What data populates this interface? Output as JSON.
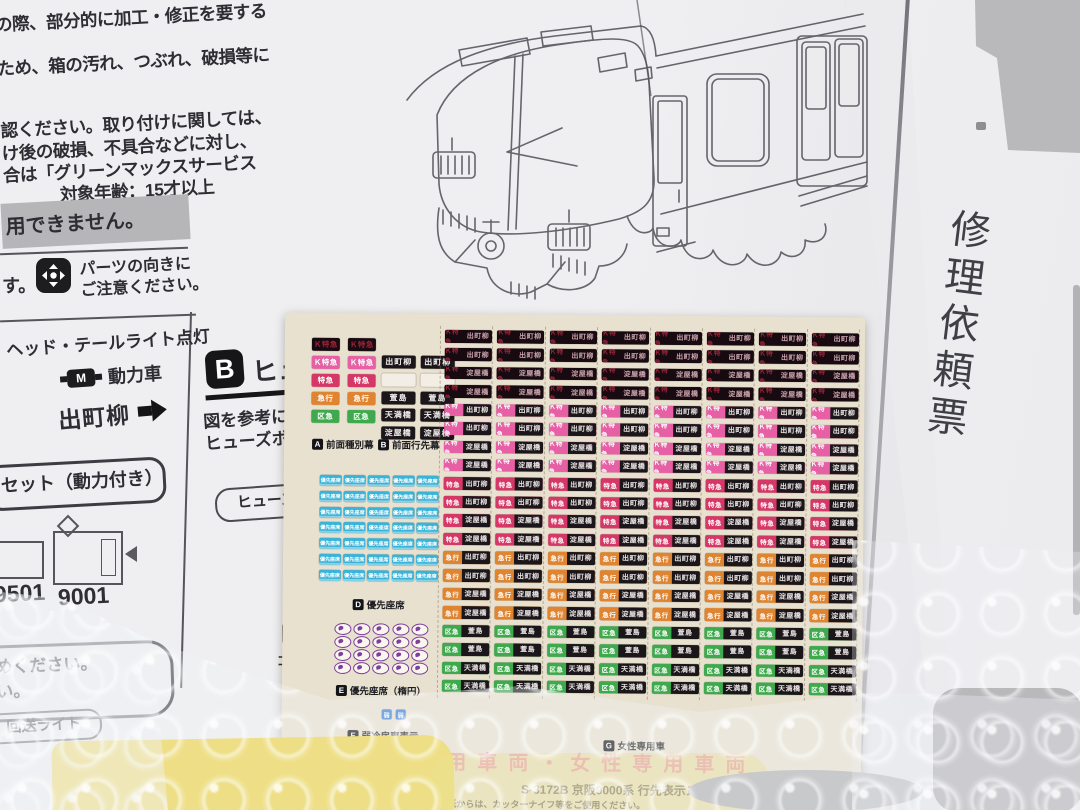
{
  "colors": {
    "led_bg": "#170b11",
    "led_text": "#9d2439",
    "dest_bg": "#1b161a",
    "dest_text": "#e9e3e3",
    "k_limited_express_pink": "#e75fa4",
    "limited_express_crimson": "#d53866",
    "express_orange": "#df8430",
    "sub_express_green": "#3fa94d",
    "priority_seat_blue": "#39b3d8",
    "priority_seat_purple": "#7d3f9b",
    "banner_pink": "#ea77ad",
    "gray_band": "#b6b6b8",
    "sheet_beige": "#e9e1d0",
    "yellow_item": "#eed54a"
  },
  "left_column": {
    "line1": "の際、部分的に加工・修正を要する",
    "line2": "ため、箱の汚れ、つぶれ、破損等に",
    "line3": "認ください。取り付けに関しては、",
    "line4": "け後の破損、不具合などに対し、",
    "line5": "合は「グリーンマックスサービス",
    "age_note": "対象年齢：15才以上",
    "gray_band": "用できません。",
    "fragment_su": "す。",
    "parts_note_line1": "パーツの向きに",
    "parts_note_line2": "ご注意ください。",
    "light_note": "ヘッド・テールライト点灯",
    "motor_icon_letter": "M",
    "motor_label": "動力車",
    "destination_label": "出町柳",
    "set_label": "セット（動力付き）",
    "num_left": "9501",
    "num_right": "9001",
    "round_note_line1": "かめください。",
    "round_note_line2": "さい。",
    "kaisou_label": "回送ライト",
    "gomu_fragment": "ゴム"
  },
  "section_b_panel": {
    "badge": "B",
    "heading_fragment": "ヒュ",
    "body_line1": "図を参考に",
    "body_line2": "ヒューズボ",
    "stadium_fragment": "ヒューズポ"
  },
  "repair_slip": {
    "vertical_title": "修理依頼票"
  },
  "sheet": {
    "section_a": {
      "badge": "A",
      "label": "前面種別幕",
      "stickers": [
        {
          "text": "Ｋ特急",
          "style": "led"
        },
        {
          "text": "Ｋ特急",
          "style": "kltd"
        },
        {
          "text": "特急",
          "style": "ltd"
        },
        {
          "text": "急行",
          "style": "exp"
        },
        {
          "text": "区急",
          "style": "sub"
        }
      ]
    },
    "section_b": {
      "badge": "B",
      "label": "前面行先幕",
      "stickers": [
        "出町柳",
        "",
        "萱島",
        "天満橋",
        "淀屋橋"
      ]
    },
    "side_grid": {
      "columns": 8,
      "rows_per_combo": 2,
      "combos": [
        {
          "type": "Ｋ特急",
          "dest": "出町柳",
          "style": "led"
        },
        {
          "type": "Ｋ特急",
          "dest": "淀屋橋",
          "style": "led"
        },
        {
          "type": "Ｋ特急",
          "dest": "出町柳",
          "style": "kltd"
        },
        {
          "type": "Ｋ特急",
          "dest": "淀屋橋",
          "style": "kltd"
        },
        {
          "type": "特急",
          "dest": "出町柳",
          "style": "ltd"
        },
        {
          "type": "特急",
          "dest": "淀屋橋",
          "style": "ltd"
        },
        {
          "type": "急行",
          "dest": "出町柳",
          "style": "exp"
        },
        {
          "type": "急行",
          "dest": "淀屋橋",
          "style": "exp"
        },
        {
          "type": "区急",
          "dest": "萱島",
          "style": "sub"
        },
        {
          "type": "区急",
          "dest": "天満橋",
          "style": "sub"
        }
      ]
    },
    "section_d": {
      "badge": "D",
      "label": "優先座席",
      "sticker_text": "優先座席",
      "cols": 5,
      "rows": 7
    },
    "section_e": {
      "badge": "E",
      "label": "優先座席（楕円）",
      "cols": 5,
      "rows": 4
    },
    "section_f": {
      "badge": "F",
      "label": "弱冷房車表示",
      "sticker_text": "弱"
    },
    "section_g": {
      "badge": "G",
      "label": "女性専用車"
    },
    "banner_text": "女性専用車両・女性専用車両",
    "product_code": "S-3172B 京阪9000系 行先表示ステッカー",
    "warning_text": "台紙からは、カッターナイフ等をご使用ください。",
    "brand": "GREEN MAX"
  }
}
